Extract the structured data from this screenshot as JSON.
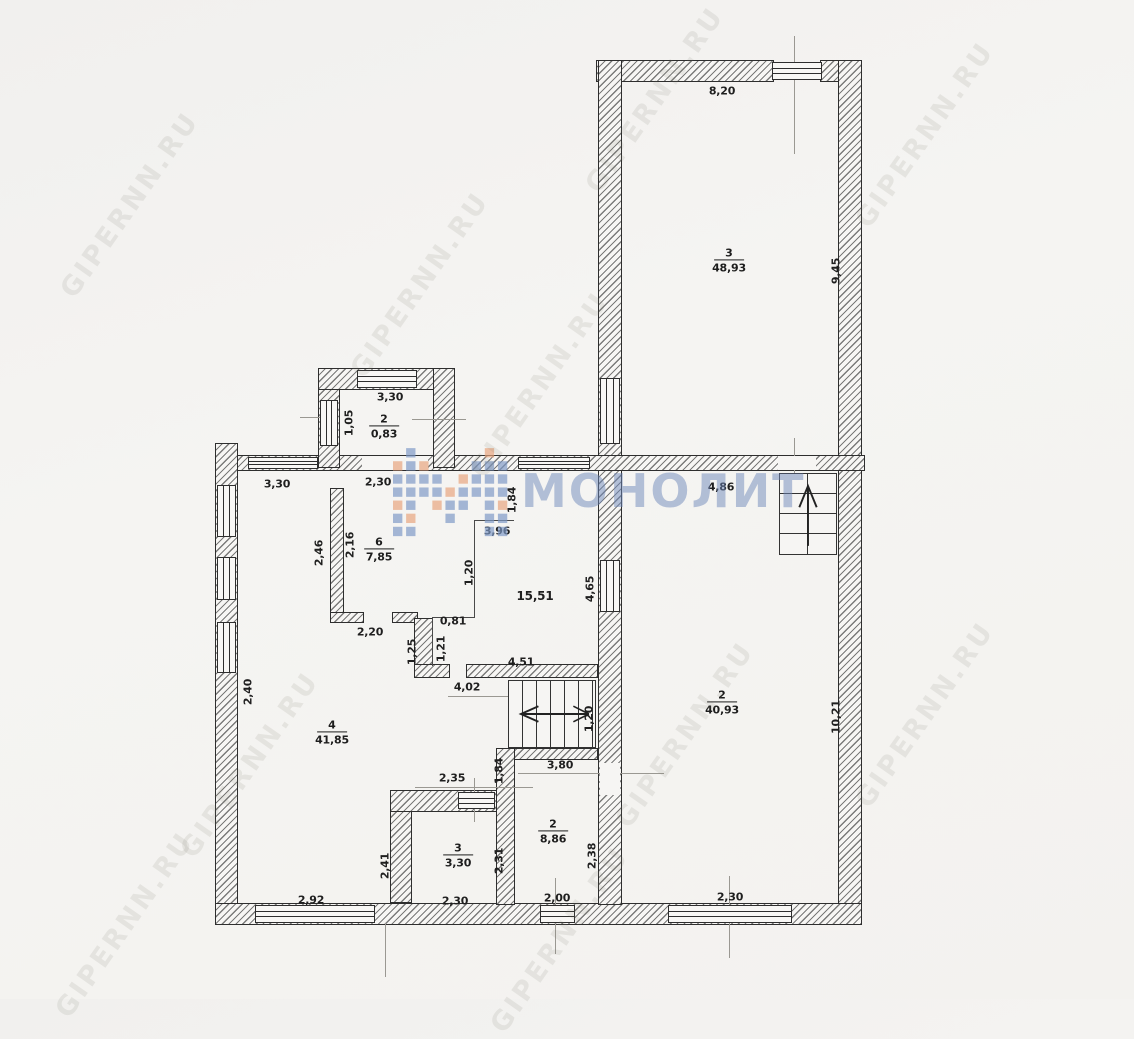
{
  "watermarks": {
    "site": "GIPERNN.RU",
    "logo": "МОНОЛИТ"
  },
  "colors": {
    "paper": "#f3f2ef",
    "wall_line": "#2e2e2e",
    "logo_blue": "#7d98c6",
    "logo_orange": "#e8a47d",
    "watermark_gray": "rgba(125,120,112,0.13)"
  },
  "rooms": {
    "room3_top": {
      "number": "3",
      "area": "48,93"
    },
    "room2_right": {
      "number": "2",
      "area": "40,93"
    },
    "room4_left": {
      "number": "4",
      "area": "41,85"
    },
    "room6_center": {
      "number": "6",
      "area": "7,85"
    },
    "room2_top_small": {
      "number": "2",
      "area": "0,83"
    },
    "hall": {
      "area": "15,51"
    },
    "room3_bottom": {
      "number": "3",
      "area": "3,30"
    },
    "room2_bottom": {
      "number": "2",
      "area": "8,86"
    }
  },
  "dims": {
    "top_width": "8,20",
    "right_height": "9,45",
    "small_room_top": "3,30",
    "small_room_left": "1,05",
    "below_small_room": "2,30",
    "top_left_width": "3,30",
    "entry_width": "4,86",
    "left_246": "2,46",
    "left_216": "2,16",
    "hall_top": "3,96",
    "hall_184": "1,84",
    "hall_left_120": "1,20",
    "hall_right_465": "4,65",
    "hall_081": "0,81",
    "hall_125": "1,25",
    "hall_121": "1,21",
    "hall_bottom_451": "4,51",
    "hall_bottom_402": "4,02",
    "room6_bottom": "2,20",
    "left_wall_240": "2,40",
    "right_wall_1021": "10,21",
    "stairs_120": "1,20",
    "dim_235": "2,35",
    "dim_184b": "1,84",
    "dim_380": "3,80",
    "room3b_left": "2,41",
    "room3b_right": "2,31",
    "room2b_right": "2,38",
    "bottom_292": "2,92",
    "bottom_230a": "2,30",
    "bottom_200": "2,00",
    "bottom_230b": "2,30"
  }
}
